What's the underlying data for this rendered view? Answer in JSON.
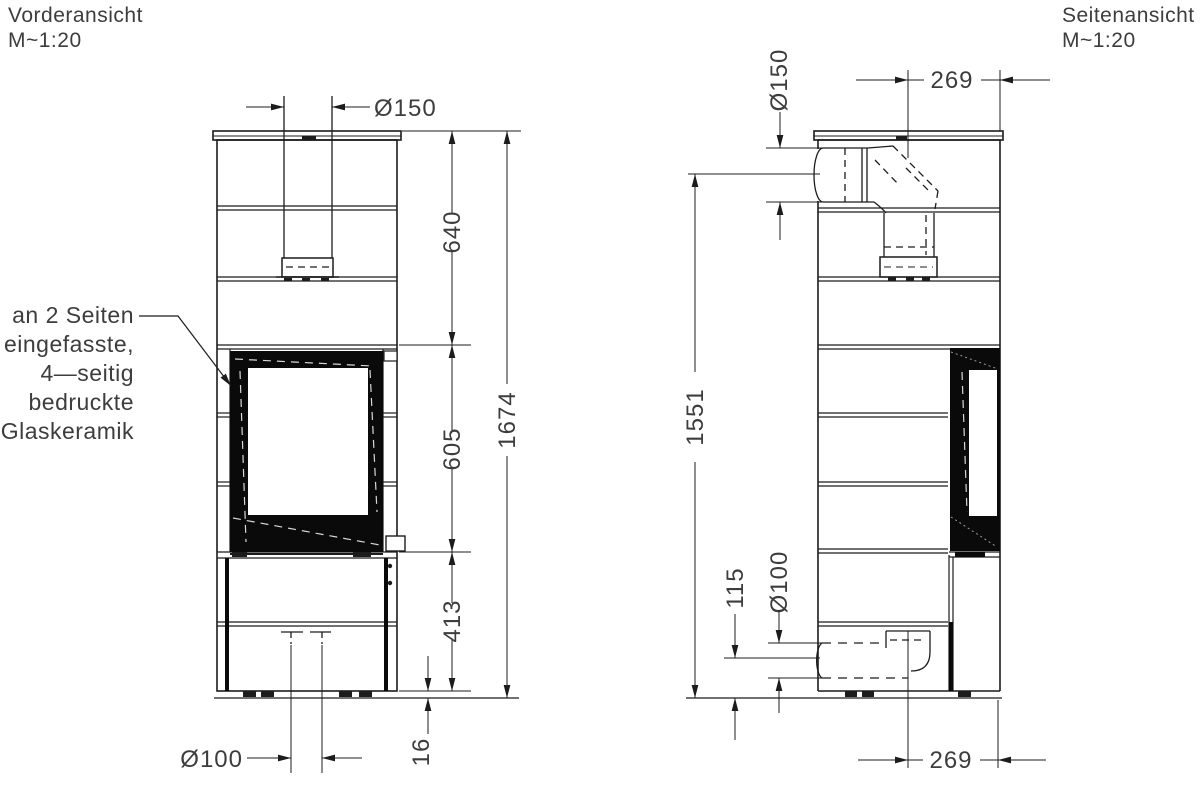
{
  "drawing": {
    "front_view": {
      "title": "Vorderansicht",
      "scale": "M~1:20",
      "dims": {
        "flue_diameter": "Ø150",
        "upper_section": "640",
        "window_height": "605",
        "lower_section": "413",
        "total_height": "1674",
        "feet_height": "16",
        "intake_diameter": "Ø100"
      },
      "annotation": {
        "lines": [
          "an 2 Seiten",
          "eingefasste,",
          "4—seitig",
          "bedruckte",
          "Glaskeramik"
        ]
      }
    },
    "side_view": {
      "title": "Seitenansicht",
      "scale": "M~1:20",
      "dims": {
        "flue_diameter": "Ø150",
        "flue_axis_offset": "269",
        "flue_axis_height": "1551",
        "intake_axis_height": "115",
        "intake_diameter": "Ø100",
        "intake_axis_offset": "269"
      }
    },
    "colors": {
      "line": "#1c1c1c",
      "text": "#3d3d3d",
      "background": "#ffffff",
      "glass_frame": "#0a0a0a"
    }
  }
}
